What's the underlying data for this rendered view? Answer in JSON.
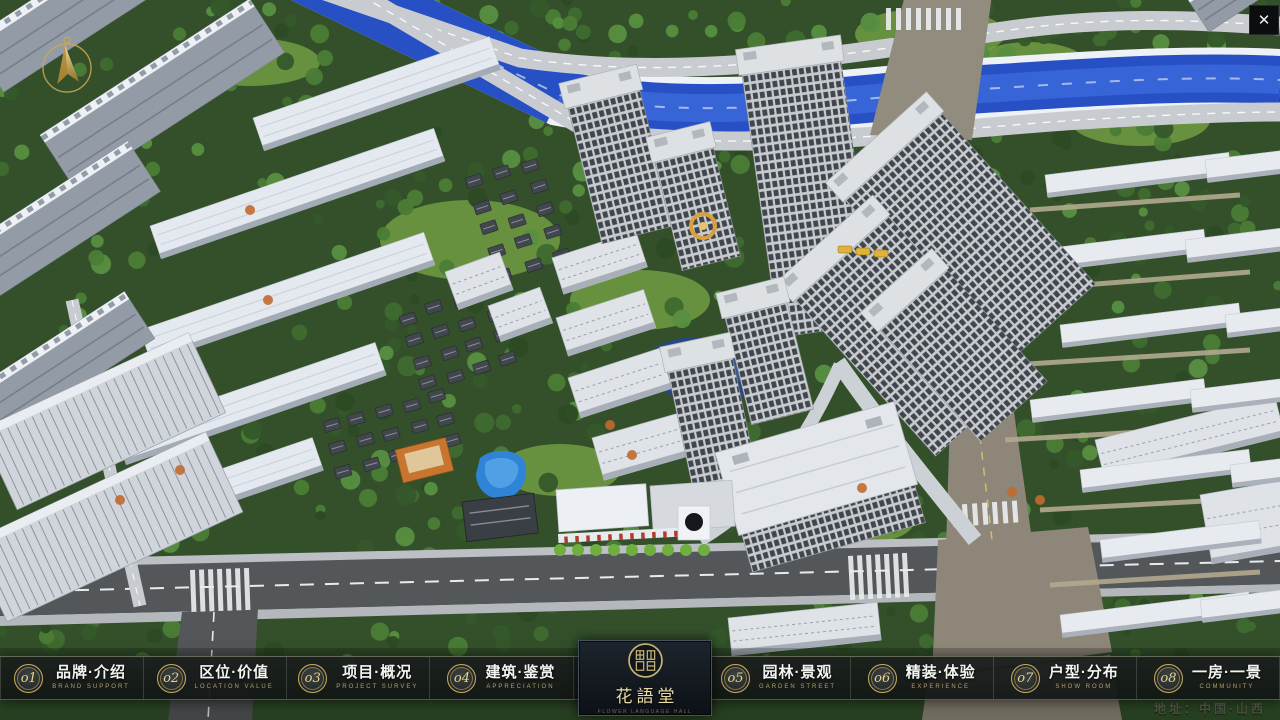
{
  "icons": {
    "close": "✕"
  },
  "nav": {
    "items": [
      {
        "num": "o1",
        "zh": "品牌·介绍",
        "en": "BRAND SUPPORT"
      },
      {
        "num": "o2",
        "zh": "区位·价值",
        "en": "LOCATION VALUE"
      },
      {
        "num": "o3",
        "zh": "项目·概况",
        "en": "PROJECT SURVEY"
      },
      {
        "num": "o4",
        "zh": "建筑·鉴赏",
        "en": "APPRECIATION"
      },
      {
        "num": "o5",
        "zh": "园林·景观",
        "en": "GARDEN STREET"
      },
      {
        "num": "o6",
        "zh": "精装·体验",
        "en": "EXPERIENCE"
      },
      {
        "num": "o7",
        "zh": "户型·分布",
        "en": "SHOW ROOM"
      },
      {
        "num": "o8",
        "zh": "一房·一景",
        "en": "COMMUNITY"
      }
    ],
    "logo": {
      "name_zh": "花語堂",
      "tagline": "FLOWER LANGUAGE HALL"
    }
  },
  "footer": {
    "address": "地址：中国·山西"
  }
}
